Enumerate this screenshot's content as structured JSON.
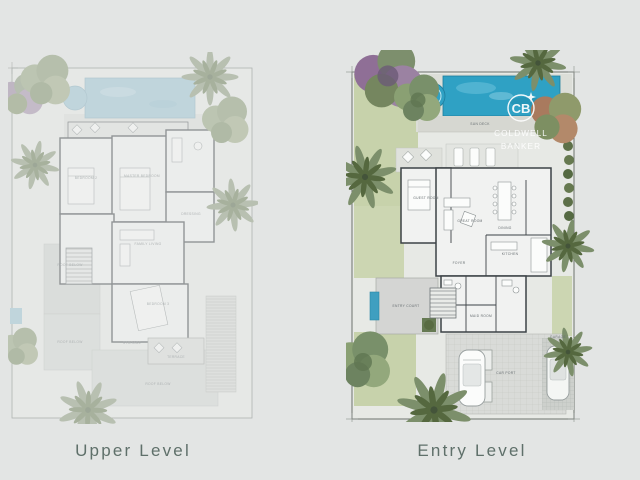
{
  "captions": {
    "left": "Upper Level",
    "right": "Entry Level"
  },
  "watermark": {
    "monogram": "CB",
    "line1": "COLDWELL",
    "line2": "BANKER"
  },
  "palette": {
    "background": "#e3e5e4",
    "pool_entry": "#2fa1c4",
    "pool_upper_faded": "#a9cbd9",
    "lawn": "#c7d2ab",
    "walls": "#3f4549",
    "deck": "#d8dad5",
    "caption_text": "#5f706a",
    "watermark_white": "#ffffff"
  },
  "upper_level": {
    "rooms": [
      "BEDROOM 2",
      "MASTER BEDROOM",
      "DRESSING",
      "FAMILY LIVING",
      "BEDROOM 3",
      "STORAGE",
      "TERRACE",
      "ROOF BELOW",
      "ROOF BELOW",
      "ROOF BELOW"
    ]
  },
  "entry_level": {
    "rooms": [
      "GUEST ROOM",
      "GREAT ROOM",
      "DINING",
      "KITCHEN",
      "FOYER",
      "ENTRY COURT",
      "SUN DECK",
      "CAR PORT",
      "GARAGE",
      "MAID ROOM"
    ]
  }
}
